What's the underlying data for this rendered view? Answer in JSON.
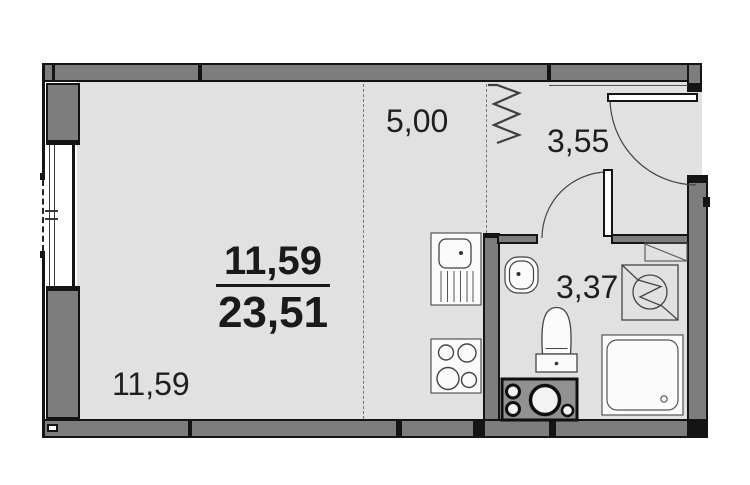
{
  "floorplan": {
    "living": {
      "area": "11,59"
    },
    "kitchen": {
      "area": "5,00"
    },
    "hall": {
      "area": "3,55"
    },
    "bath": {
      "area": "3,37"
    },
    "summary": {
      "living_area": "11,59",
      "total_area": "23,51"
    },
    "colors": {
      "wall": "#7d7d7d",
      "floor": "#e1e1e1",
      "outline": "#141414",
      "fixture_stroke": "#444444"
    },
    "fixtures": [
      "window",
      "entrance-door",
      "bathroom-door",
      "kitchen-sink",
      "cooktop",
      "washbasin",
      "toilet",
      "washing-machine",
      "shower-tray",
      "plumbing-unit",
      "ventilation-zigzag"
    ]
  }
}
